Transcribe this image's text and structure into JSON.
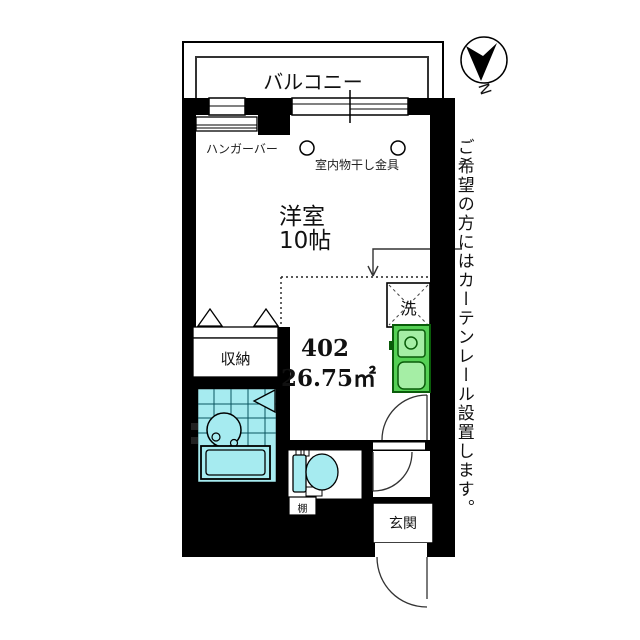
{
  "compass": {
    "north_label": "N"
  },
  "balcony": {
    "label": "バルコニー"
  },
  "room": {
    "name": "洋室",
    "size": "10帖"
  },
  "unit": {
    "number": "402",
    "area": "26.75㎡"
  },
  "fixtures": {
    "hanger_bar": "ハンガーバー",
    "drying_hook": "室内物干し金具",
    "washer": "洗",
    "closet": "収納",
    "shelf": "棚",
    "entrance": "玄関"
  },
  "note": "ご希望の方にはカーテンレール設置します。",
  "colors": {
    "wall": "#000000",
    "bath": "#a6ebf0",
    "bath_line": "#0a5560",
    "kitchen_dark": "#55d055",
    "kitchen_light": "#a5eea5",
    "kitchen_border": "#0a5c0a"
  }
}
